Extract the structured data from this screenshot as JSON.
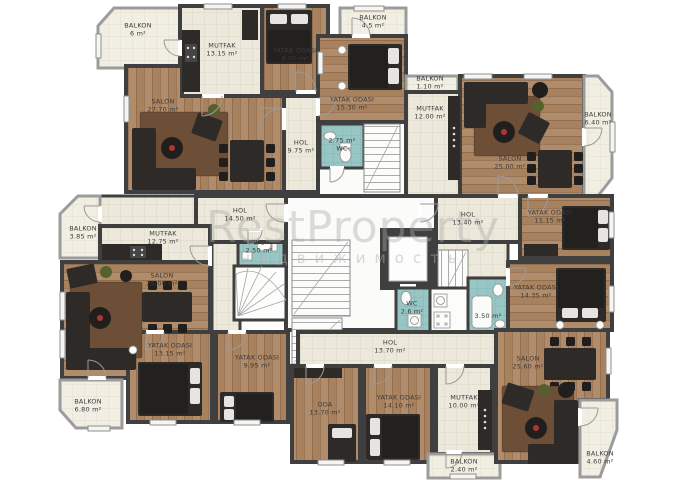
{
  "watermark": {
    "brand": "RestProperty",
    "subtitle": "недвижимость"
  },
  "colors": {
    "wall": "#3f3f3f",
    "tile_floor": "#ece8db",
    "balcony_floor": "#f1eee3",
    "wood_floor": "#b18c6b",
    "bathroom": "#97c6c5",
    "rug": "#6d4e36",
    "furniture": "#2d2a27",
    "accent_flower": "#b33434"
  },
  "rooms": [
    {
      "lines": [
        "BALKON",
        "6 m²"
      ]
    },
    {
      "lines": [
        "MUTFAK",
        "13.15 m²"
      ]
    },
    {
      "lines": [
        "YATAK ODASI",
        "9.00 m²"
      ]
    },
    {
      "lines": [
        "SALON",
        "27.70 m²"
      ]
    },
    {
      "lines": [
        "HOL",
        "9.75 m²"
      ]
    },
    {
      "lines": [
        "BALKON",
        "4.5 m²"
      ]
    },
    {
      "lines": [
        "YATAK ODASI",
        "15.30 m²"
      ]
    },
    {
      "lines": [
        "2.75 m²",
        "WC"
      ]
    },
    {
      "lines": [
        "BALKON",
        "1.10 m²"
      ]
    },
    {
      "lines": [
        "MUTFAK",
        "12.00 m²"
      ]
    },
    {
      "lines": [
        "SALON",
        "25.00 m²"
      ]
    },
    {
      "lines": [
        "BALKON",
        "6.40 m²"
      ]
    },
    {
      "lines": [
        "HOL",
        "13.40 m²"
      ]
    },
    {
      "lines": [
        "YATAK ODASI",
        "11.15 m²"
      ]
    },
    {
      "lines": [
        "HOL",
        "14.50 m²"
      ]
    },
    {
      "lines": [
        "WC",
        "2.50 m²"
      ]
    },
    {
      "lines": [
        "BALKON",
        "3.85 m²"
      ]
    },
    {
      "lines": [
        "MUTFAK",
        "12.75 m²"
      ]
    },
    {
      "lines": [
        "SALON",
        "25.00 m²"
      ]
    },
    {
      "lines": [
        "YATAK ODASI",
        "13.15 m²"
      ]
    },
    {
      "lines": [
        "BALKON",
        "6.80 m²"
      ]
    },
    {
      "lines": [
        "YATAK ODASI",
        "9.95 m²"
      ]
    },
    {
      "lines": [
        "HOL",
        "13.70 m²"
      ]
    },
    {
      "lines": [
        "ODA",
        "13.70 m²"
      ]
    },
    {
      "lines": [
        "YATAK ODASI",
        "14.10 m²"
      ]
    },
    {
      "lines": [
        "MUTFAK",
        "10.00 m²"
      ]
    },
    {
      "lines": [
        "BALKON",
        "2.40 m²"
      ]
    },
    {
      "lines": [
        "YATAK ODASI",
        "14.35 m²"
      ]
    },
    {
      "lines": [
        "WC",
        "2.6 m²"
      ]
    },
    {
      "lines": [
        "3.50 m²"
      ]
    },
    {
      "lines": [
        "SALON",
        "25.60 m²"
      ]
    },
    {
      "lines": [
        "BALKON",
        "4.60 m²"
      ]
    }
  ]
}
